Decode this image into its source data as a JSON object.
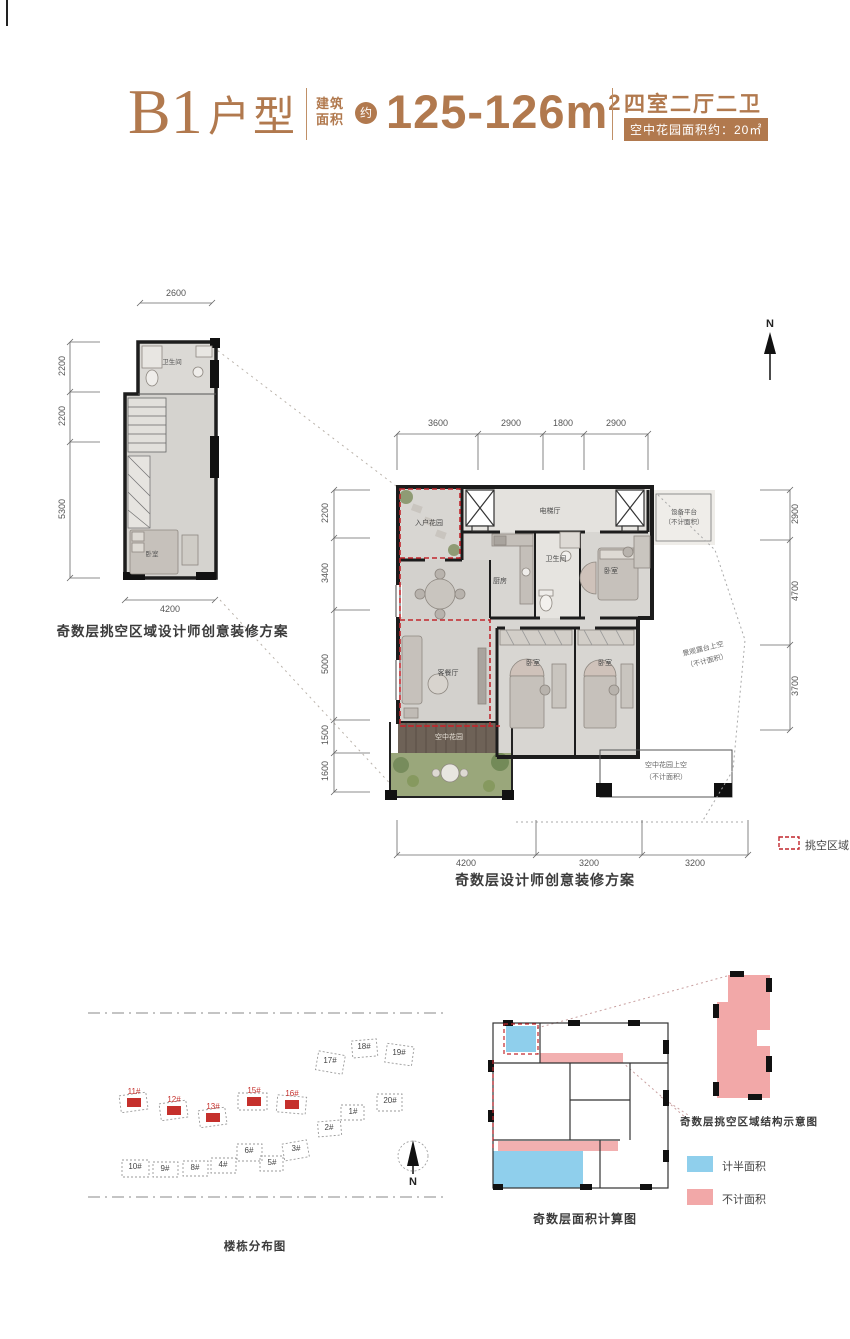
{
  "header": {
    "code": "B1",
    "type_suffix": "户型",
    "area_label_l1": "建筑",
    "area_label_l2": "面积",
    "approx": "约",
    "area_value": "125-126m",
    "area_sup": "2",
    "rooms_label": "四室二厅二卫",
    "garden_badge": "空中花园面积约：20㎡"
  },
  "small_plan": {
    "caption": "奇数层挑空区域设计师创意装修方案",
    "dim_top": "2600",
    "dims_left": [
      "2200",
      "2200",
      "5300"
    ],
    "dim_bottom": "4200",
    "rooms": {
      "bath": "卫生间",
      "bedroom": "卧室"
    }
  },
  "main_plan": {
    "caption": "奇数层设计师创意装修方案",
    "north": "N",
    "dims_top": [
      "3600",
      "2900",
      "1800",
      "2900"
    ],
    "dims_left": [
      "2200",
      "3400",
      "5000",
      "1500",
      "1600"
    ],
    "dims_right": [
      "2900",
      "4700",
      "3700"
    ],
    "dims_bottom": [
      "4200",
      "3200",
      "3200"
    ],
    "rooms": {
      "entry_garden": "入户花园",
      "elevator_hall": "电梯厅",
      "equipment_l1": "设备平台",
      "equipment_l2": "（不计面积）",
      "kitchen": "厨房",
      "bath": "卫生间",
      "bedroom_a": "卧室",
      "bedroom_b": "卧室",
      "bedroom_c": "卧室",
      "living": "客餐厅",
      "sky_garden": "空中花园",
      "terrace_l1": "景观露台上空",
      "terrace_l2": "（不计面积）",
      "garden_above_l1": "空中花园上空",
      "garden_above_l2": "（不计面积）"
    },
    "legend_void": "挑空区域"
  },
  "site_plan": {
    "caption": "楼栋分布图",
    "north": "N",
    "buildings": [
      {
        "label": "11#",
        "highlight": true
      },
      {
        "label": "12#",
        "highlight": true
      },
      {
        "label": "13#",
        "highlight": true
      },
      {
        "label": "15#",
        "highlight": true
      },
      {
        "label": "16#",
        "highlight": true
      },
      {
        "label": "17#"
      },
      {
        "label": "18#"
      },
      {
        "label": "19#"
      },
      {
        "label": "20#"
      },
      {
        "label": "1#"
      },
      {
        "label": "2#"
      },
      {
        "label": "3#"
      },
      {
        "label": "4#"
      },
      {
        "label": "5#"
      },
      {
        "label": "6#"
      },
      {
        "label": "8#"
      },
      {
        "label": "9#"
      },
      {
        "label": "10#"
      }
    ]
  },
  "structure": {
    "caption": "奇数层面积计算图",
    "annotation": "奇数层挑空区域结构示意图",
    "legend": [
      {
        "label": "计半面积",
        "color": "#8fcfec"
      },
      {
        "label": "不计面积",
        "color": "#f2a8a8"
      }
    ]
  },
  "colors": {
    "accent": "#b1794e",
    "void_red": "#c1272d",
    "half_blue": "#8fcfec",
    "uncounted_pink": "#f2a8a8"
  }
}
